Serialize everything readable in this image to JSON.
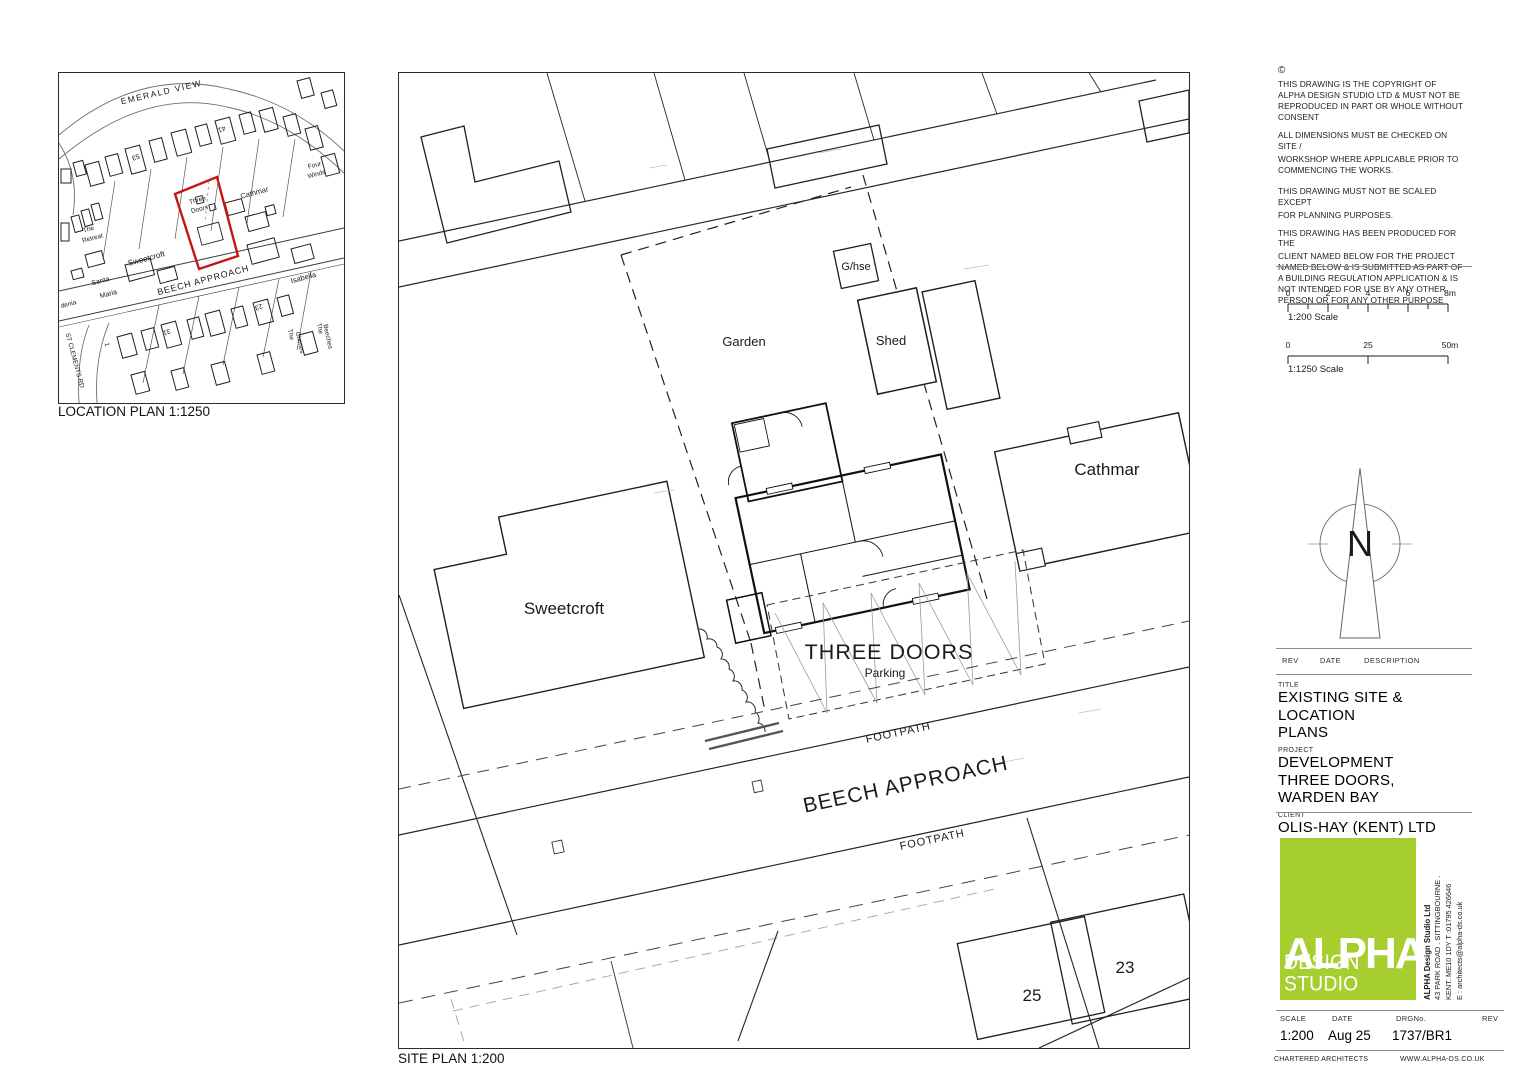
{
  "location_plan": {
    "caption": "LOCATION PLAN 1:1250",
    "site_outline_color": "#c81414",
    "labels": {
      "emerald_view": "EMERALD VIEW",
      "no53": "53",
      "no41": "41",
      "four_winds1": "Four",
      "four_winds2": "Winds",
      "cathmar": "Cathmar",
      "three1": "Three",
      "three2": "Doors",
      "isabella": "Isabella",
      "sweetcroft": "Sweetcroft",
      "retreat1": "The",
      "retreat2": "Retreat",
      "santa": "Santa",
      "maria": "Maria",
      "denia": "denia",
      "beech": "BEECH APPROACH",
      "st_clements": "ST CLEMENTS RD",
      "no23": "23",
      "no31": "31",
      "no1": "1",
      "chimes1": "The",
      "chimes2": "Chimes",
      "beeches1": "The",
      "beeches2": "Beeches"
    }
  },
  "site_plan": {
    "caption": "SITE PLAN 1:200",
    "labels": {
      "garden": "Garden",
      "ghse": "G/hse",
      "shed": "Shed",
      "cathmar": "Cathmar",
      "sweetcroft": "Sweetcroft",
      "three_doors": "THREE DOORS",
      "parking": "Parking",
      "footpath_upper": "FOOTPATH",
      "beech": "BEECH APPROACH",
      "footpath_lower": "FOOTPATH",
      "no25": "25",
      "no23": "23"
    }
  },
  "titleblock": {
    "copyright_symbol": "©",
    "notes": {
      "n1": "THIS DRAWING IS THE COPYRIGHT OF ALPHA DESIGN STUDIO LTD & MUST NOT BE REPRODUCED IN PART OR WHOLE WITHOUT CONSENT",
      "n2": "ALL DIMENSIONS MUST BE CHECKED ON SITE /",
      "n3": "WORKSHOP WHERE APPLICABLE PRIOR TO COMMENCING THE WORKS.",
      "n4": "THIS DRAWING MUST NOT BE SCALED EXCEPT",
      "n5": "FOR PLANNING PURPOSES.",
      "n6": "THIS DRAWING HAS BEEN PRODUCED FOR THE",
      "n7": "CLIENT NAMED BELOW FOR THE PROJECT NAMED BELOW & IS SUBMITTED AS PART OF A BUILDING REGULATION APPLICATION & IS NOT INTENDED FOR USE BY ANY OTHER PERSON OR FOR ANY OTHER PURPOSE"
    },
    "scalebar200": {
      "t0": "0",
      "t2": "2",
      "t4": "4",
      "t6": "6",
      "t8": "8m",
      "label": "1:200 Scale"
    },
    "scalebar1250": {
      "t0": "0",
      "t25": "25",
      "t50": "50m",
      "label": "1:1250 Scale"
    },
    "north_letter": "N",
    "rev_header": {
      "rev": "REV",
      "date": "DATE",
      "desc": "DESCRIPTION"
    },
    "title_label": "TITLE",
    "title": "EXISTING SITE & LOCATION PLANS",
    "project_label": "PROJECT",
    "project": "DEVELOPMENT THREE DOORS, WARDEN BAY",
    "client_label": "CLIENT",
    "client": "OLIS-HAY (KENT) LTD",
    "logo": {
      "word": "ALPHA",
      "sub": "DESIGN STUDIO",
      "green": "#a6ce2e",
      "company": "ALPHA Design Studio Ltd",
      "addr1": "43 PARK ROAD . SITTINGBOURNE .",
      "addr2": "KENT. ME10 1DY T :01795 426646",
      "addr3": "E : architects@alpha-ds.co.uk"
    },
    "footer": {
      "scale_label": "SCALE",
      "scale": "1:200",
      "date_label": "DATE",
      "date": "Aug 25",
      "drg_label": "DRGNo.",
      "drg": "1737/BR1",
      "rev_label": "REV",
      "chartered": "CHARTERED ARCHITECTS",
      "website": "WWW.ALPHA-DS.CO.UK"
    }
  }
}
